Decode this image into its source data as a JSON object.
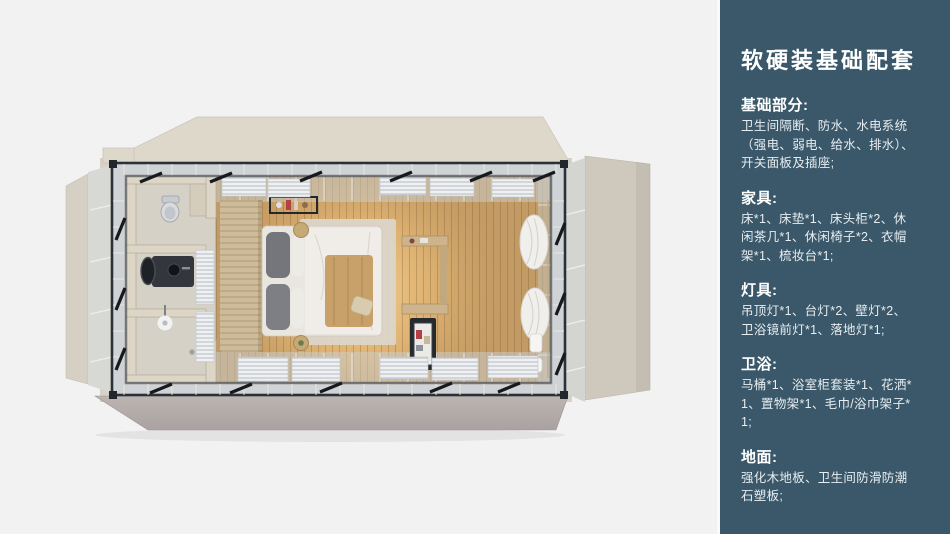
{
  "colors": {
    "canvas_bg": "#f2f2f3",
    "panel_bg": "#3a5869",
    "panel_divider": "#fafafa",
    "panel_heading_text": "#ffffff",
    "panel_body_text": "#e7edf1",
    "shell_beige": "#d8d1c5",
    "steel_frame": "#2b3139",
    "wood_floor": "#c29a64",
    "floor_glow": "#f8d492"
  },
  "panel": {
    "title": "软硬装基础配套",
    "sections": [
      {
        "heading": "基础部分:",
        "body": "卫生间隔断、防水、水电系统（强电、弱电、给水、排水）、开关面板及插座;"
      },
      {
        "heading": "家具:",
        "body": "床*1、床垫*1、床头柜*2、休闲茶几*1、休闲椅子*2、衣帽架*1、梳妆台*1;"
      },
      {
        "heading": "灯具:",
        "body": "吊顶灯*1、台灯*2、壁灯*2、卫浴镜前灯*1、落地灯*1;"
      },
      {
        "heading": "卫浴:",
        "body": "马桶*1、浴室柜套装*1、花洒*1、置物架*1、毛巾/浴巾架子*1;"
      },
      {
        "heading": "地面:",
        "body": "强化木地板、卫生间防滑防潮石塑板;"
      }
    ]
  }
}
